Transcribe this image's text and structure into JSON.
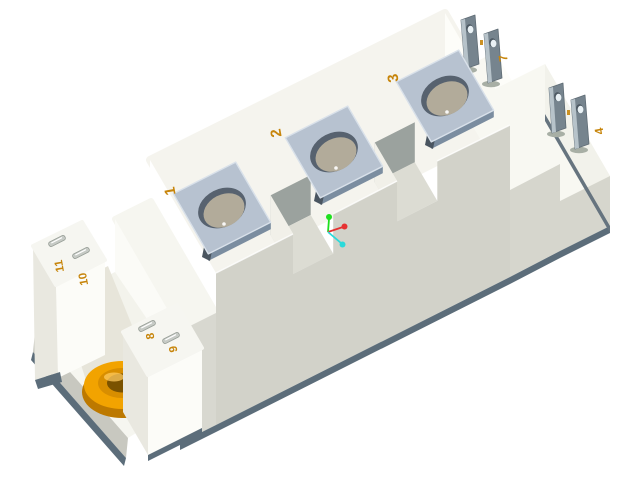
{
  "scene": {
    "description": "3D CAD isometric render of an IGBT power semiconductor module",
    "background": "#ffffff"
  },
  "labels": {
    "pad1": "1",
    "pad2": "2",
    "pad3": "3",
    "tab_right": "4",
    "tab_top": "7",
    "pin8": "8",
    "pin9": "9",
    "pin10": "10",
    "pin11": "11"
  },
  "label_color": "#c7850b",
  "materials": {
    "body": "#f5f4ee",
    "front_face": "#d2d2c9",
    "baseplate": "#5c6d7a",
    "pad_metal_top": "#b7c2d0",
    "pad_metal_side": "#8294a6",
    "hole_floor": "#b2ab9a",
    "tab_metal": "#76848e",
    "bushing_top": "#f2a300",
    "bushing_side": "#bd7900"
  },
  "axis_indicator": {
    "x_color": "#e63232",
    "y_color": "#1ee01e",
    "z_color": "#2adada"
  }
}
